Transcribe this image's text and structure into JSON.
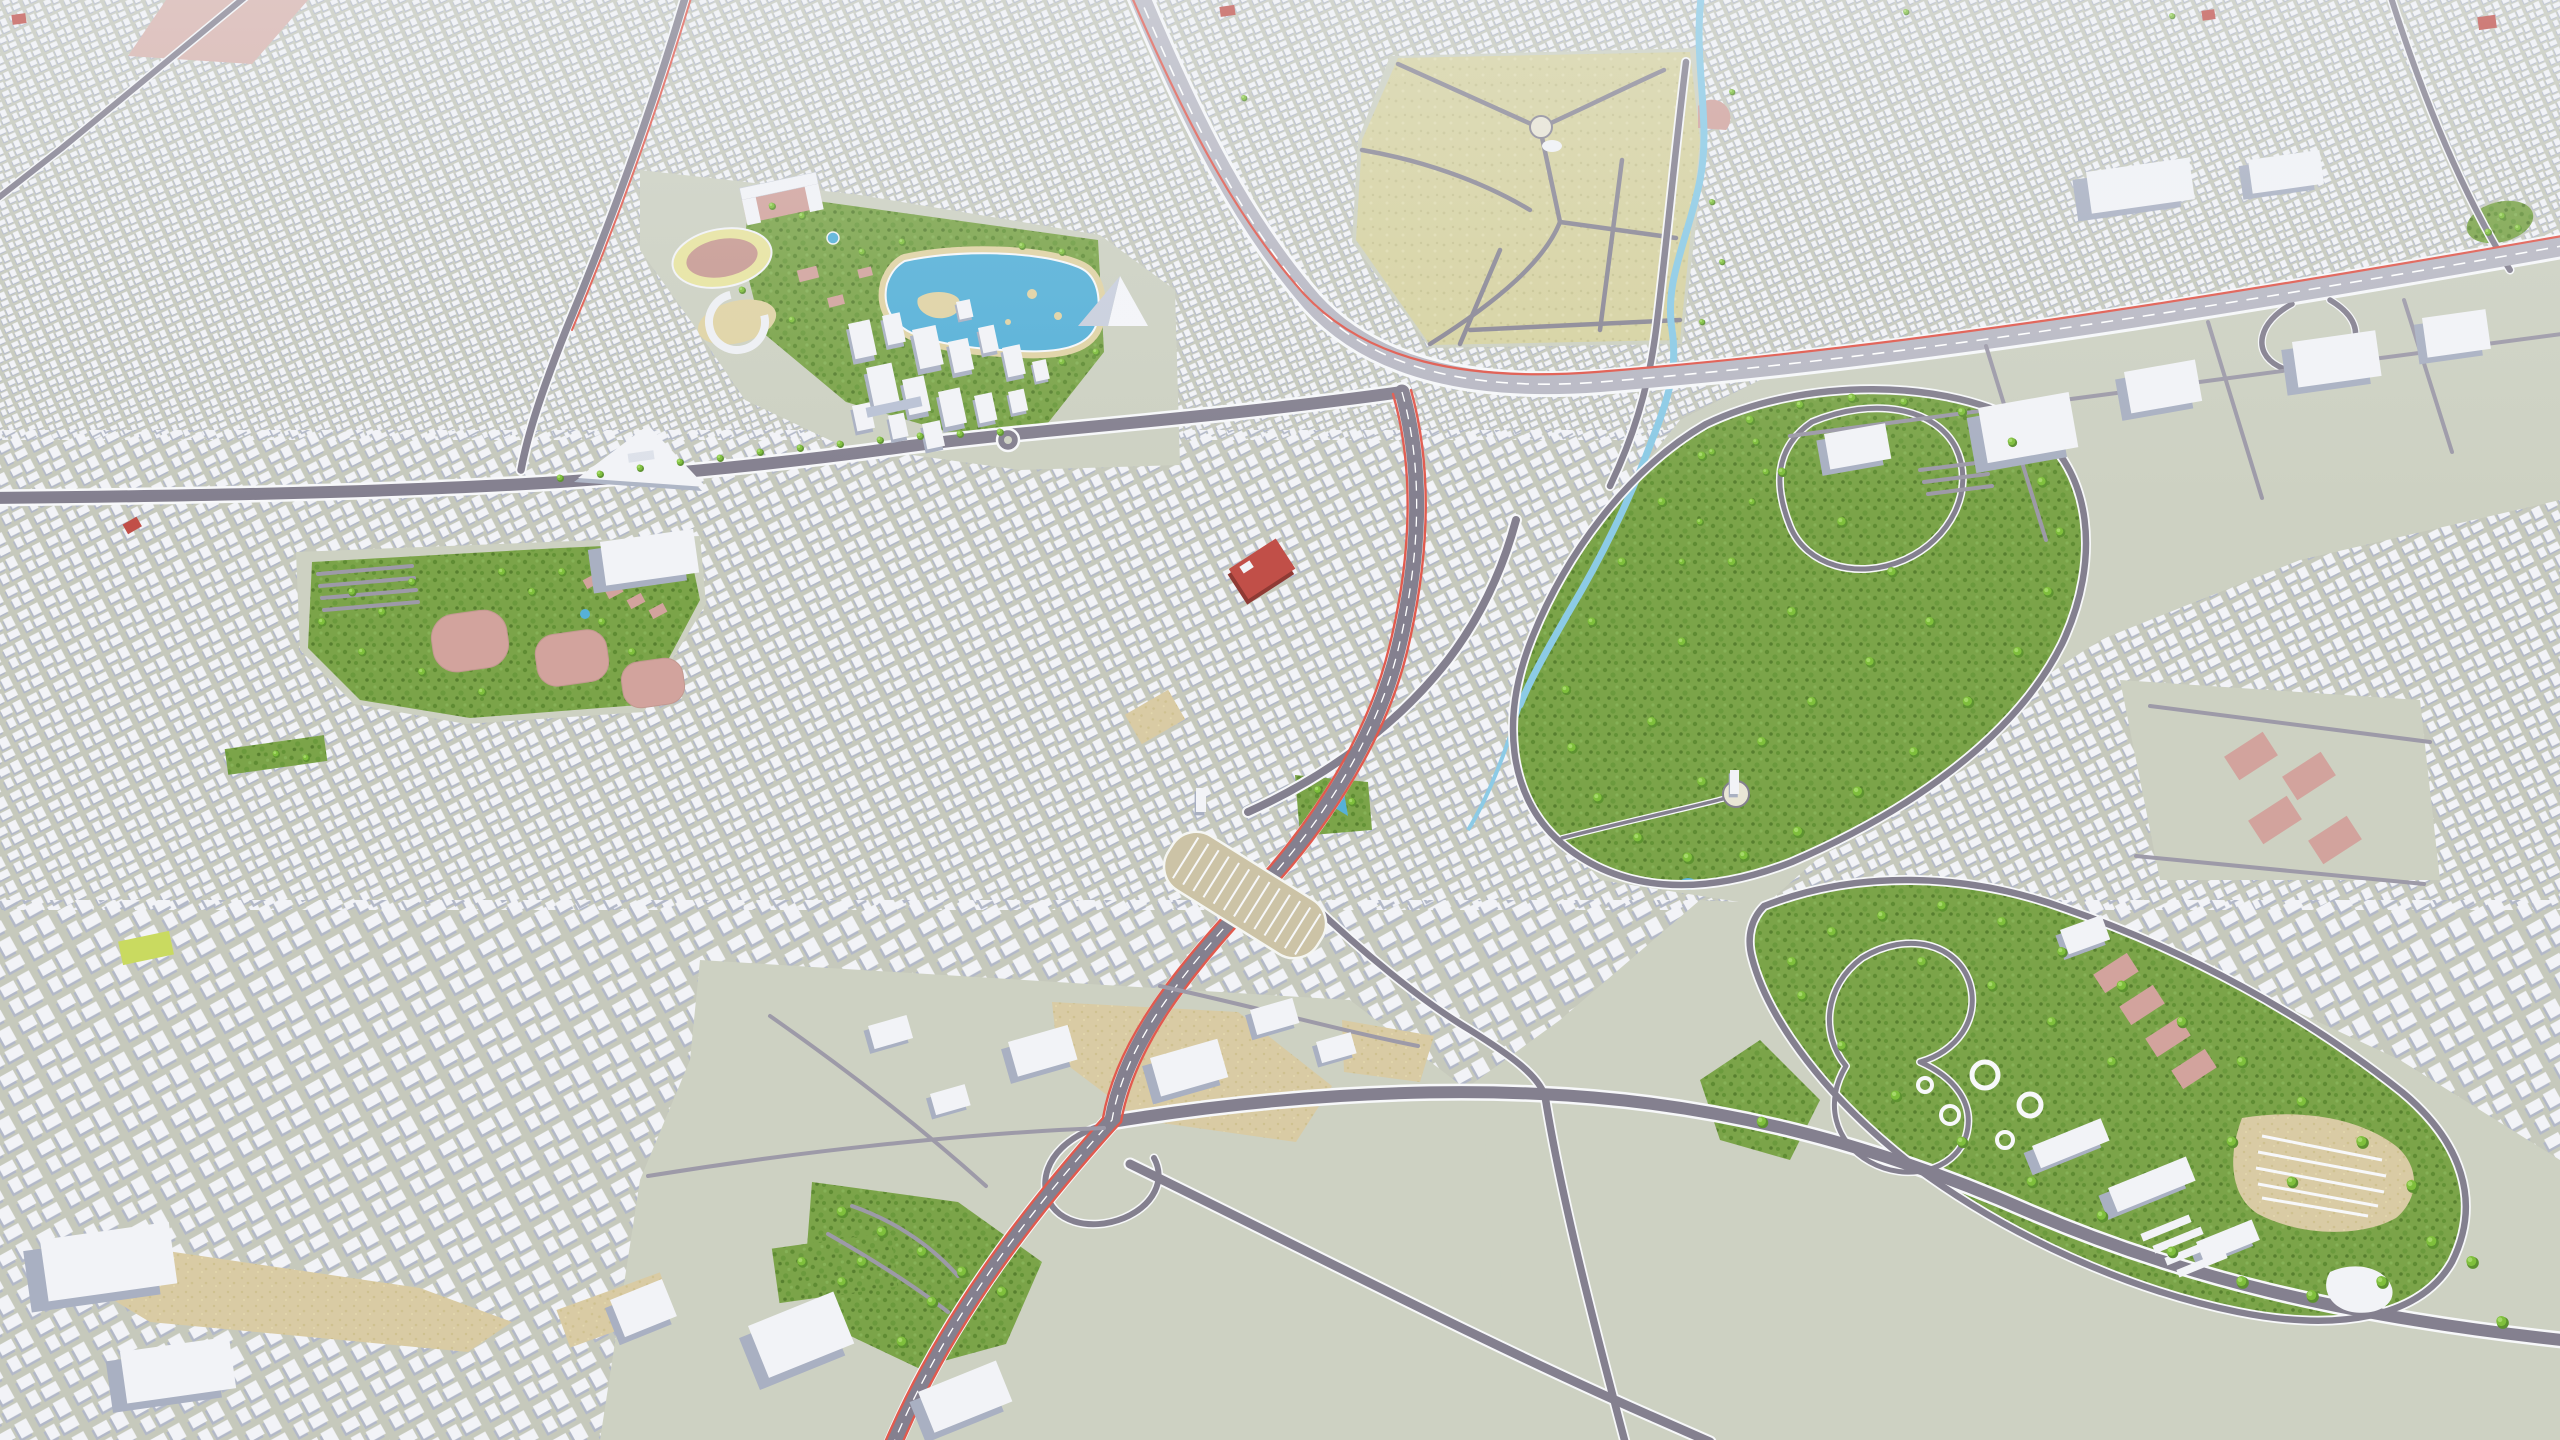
{
  "scene": {
    "kind": "3d-city-model-aerial-render",
    "view": "oblique high-angle aerial view of a large low-poly city",
    "palette": {
      "ground": "#c6c9bc",
      "open_ground": "#cdd1c2",
      "building_top": "#f2f3f7",
      "building_shadow": "#b2b8c8",
      "big_building_shadow": "#a9b0c2",
      "building_outline": "#c9ced8",
      "road_casing": "#f7f8fa",
      "road_minor": "#9d9aa8",
      "road_major": "#84808f",
      "road_highway": "#b9b9c4",
      "road_khaki": "#8b8896",
      "lane_dash": "#ffffff",
      "route_red": "#e15a4e",
      "park_green": "#7ba449",
      "park_dot_dark": "#5f8c33",
      "park_dot_mid": "#6b9a3d",
      "tree_dark": "#5d9230",
      "tree_light": "#7fbf3c",
      "tree_highlight": "#a4d968",
      "water": "#56b1d8",
      "river": "#8ccbe6",
      "sand": "#e0d3a4",
      "khaki": "#d7d3a2",
      "khaki_dot": "#c8c492",
      "tan_lot": "#d9cba4",
      "tan_dot": "#cfc190",
      "pink_field": "#d2a39d",
      "pink_strip": "#d9b3ad",
      "red_building": "#c14f48",
      "red_building_side": "#8f3a34",
      "track_yellow": "#e8e4a0",
      "infield_pink": "#c89a92",
      "plaza_light": "#e9e6d6",
      "station_slab": "#b9c2d4",
      "lawn_yellow": "#c9da60",
      "terminal_base": "#ccc3a6"
    },
    "features": [
      {
        "name": "city-fabric",
        "kind": "dense low-rise white building blocks",
        "coverage": "majority of frame"
      },
      {
        "name": "stadium",
        "kind": "athletics track oval with pink infield",
        "area": "upper-left"
      },
      {
        "name": "aquatic-lake",
        "kind": "blue lake with sand islands and promenade",
        "area": "upper-left"
      },
      {
        "name": "pyramid-building",
        "kind": "pyramidal landmark beside lake",
        "area": "upper-left"
      },
      {
        "name": "downtown-towers",
        "kind": "mid-rise tower cluster",
        "area": "center-left"
      },
      {
        "name": "parade-grounds",
        "kind": "large khaki open grounds with radial roads and round plaza",
        "area": "top-center"
      },
      {
        "name": "river",
        "kind": "winding light-blue stream",
        "area": "top-center flowing south"
      },
      {
        "name": "central-park",
        "kind": "large tree-filled park with ring road and loop paths",
        "area": "center-right"
      },
      {
        "name": "amusement-park",
        "kind": "park with ride loops, round plazas and pavilions",
        "area": "lower-right"
      },
      {
        "name": "fairground-parking",
        "kind": "fan shaped striped parking lot",
        "area": "lower-right"
      },
      {
        "name": "bus-terminal",
        "kind": "striped bus depot oval",
        "area": "center-bottom beside avenue"
      },
      {
        "name": "highway",
        "kind": "multi-lane motorway with red edge line",
        "route": "from top-center curving to right edge"
      },
      {
        "name": "grand-avenue",
        "kind": "wide boulevard with red edge lines",
        "route": "center junction to bottom-left"
      },
      {
        "name": "east-west-arterial",
        "kind": "arterial with green tree-planted median",
        "route": "left edge to center junction"
      },
      {
        "name": "interchange",
        "kind": "major road junction with ramps",
        "area": "bottom-center"
      },
      {
        "name": "red-building",
        "kind": "flat red landmark block",
        "area": "center"
      },
      {
        "name": "courts-park",
        "kind": "green park with rounded pink sports fields",
        "area": "center-left"
      },
      {
        "name": "pink-courts",
        "kind": "four pink sports fields on open ground",
        "area": "right-middle"
      },
      {
        "name": "market-strip",
        "kind": "pink linear plaza strip",
        "area": "top-left"
      },
      {
        "name": "industrial-band",
        "kind": "large flat white halls with parking",
        "area": "right of center below highway"
      },
      {
        "name": "triangle-hall",
        "kind": "large white triangular building",
        "area": "center-left"
      },
      {
        "name": "interchange-park",
        "kind": "small green park with paths",
        "area": "bottom-center-left"
      },
      {
        "name": "malls",
        "kind": "big white flat commercial buildings",
        "area": "bottom-left"
      }
    ]
  }
}
